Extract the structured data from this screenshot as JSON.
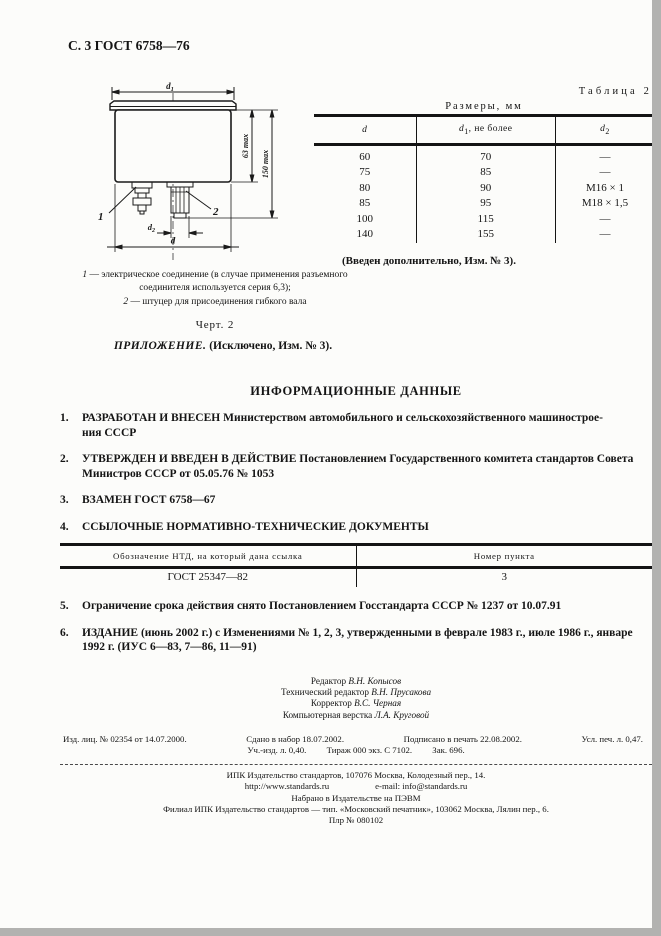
{
  "page_header": "С. 3 ГОСТ 6758—76",
  "figure": {
    "d1_base": "d",
    "d1_sub": "1",
    "max63": "63 max",
    "max150": "150 max",
    "d2_base": "d",
    "d2_sub": "2",
    "d_label": "d",
    "callout1": "1",
    "callout2": "2",
    "note1_num": "1",
    "note1_text": "— электрическое соединение (в случае применения разъемного соединителя используется серия 6,3);",
    "note2_num": "2",
    "note2_text": "— штуцер для присоединения гибкого вала",
    "caption": "Черт. 2"
  },
  "appendix": {
    "italic": "ПРИЛОЖЕНИЕ.",
    "bold": "(Исключено, Изм. № 3)."
  },
  "table2": {
    "label": "Таблица 2",
    "title": "Размеры, мм",
    "h1": "d",
    "h2_base": "d",
    "h2_sub": "1",
    "h2_rest": ", не более",
    "h3_base": "d",
    "h3_sub": "2",
    "rows": [
      [
        "60",
        "70",
        "—"
      ],
      [
        "75",
        "85",
        "—"
      ],
      [
        "80",
        "90",
        "М16 × 1"
      ],
      [
        "85",
        "95",
        "М18 × 1,5"
      ],
      [
        "100",
        "115",
        "—"
      ],
      [
        "140",
        "155",
        "—"
      ]
    ],
    "note": "(Введен дополнительно, Изм. № 3)."
  },
  "info": {
    "title": "ИНФОРМАЦИОННЫЕ ДАННЫЕ",
    "item1_num": "1.",
    "item1_line1": "РАЗРАБОТАН И ВНЕСЕН Министерством автомобильного и сельскохозяйственного машинострое-",
    "item1_line2": "ния СССР",
    "item2_num": "2.",
    "item2_text": "УТВЕРЖДЕН И ВВЕДЕН В ДЕЙСТВИЕ Постановлением Государственного комитета стандартов Совета Министров СССР от 05.05.76 № 1053",
    "item3_num": "3.",
    "item3_text": "ВЗАМЕН ГОСТ 6758—67",
    "item4_num": "4.",
    "item4_text": "ССЫЛОЧНЫЕ НОРМАТИВНО-ТЕХНИЧЕСКИЕ ДОКУМЕНТЫ",
    "item5_num": "5.",
    "item5_text": "Ограничение срока действия снято Постановлением Госстандарта СССР № 1237 от 10.07.91",
    "item6_num": "6.",
    "item6_text": "ИЗДАНИЕ (июнь 2002 г.) с Изменениями №  1, 2, 3, утвержденными в феврале 1983 г., июле 1986 г., январе 1992 г. (ИУС 6—83, 7—86, 11—91)"
  },
  "ref_table": {
    "col1": "Обозначение НТД, на который дана ссылка",
    "col2": "Номер пункта",
    "row": [
      "ГОСТ 25347—82",
      "3"
    ]
  },
  "credits": [
    {
      "role": "Редактор",
      "name": "В.Н. Копысов"
    },
    {
      "role": "Технический редактор",
      "name": "В.Н. Прусакова"
    },
    {
      "role": "Корректор",
      "name": "В.С. Черная"
    },
    {
      "role": "Компьютерная верстка",
      "name": "Л.А. Круговой"
    }
  ],
  "imprint": {
    "line1a": "Изд. лиц. № 02354 от 14.07.2000.",
    "line1b": "Сдано в набор 18.07.2002.",
    "line1c": "Подписано в печать 22.08.2002.",
    "line1d": "Усл. печ. л. 0,47.",
    "line2a": "Уч.-изд. л. 0,40.",
    "line2b": "Тираж 000 экз. С 7102.",
    "line2c": "Зак. 696.",
    "pub1": "ИПК Издательство стандартов, 107076 Москва, Колодезный пер., 14.",
    "pub2a": "http://www.standards.ru",
    "pub2b": "e-mail: info@standards.ru",
    "pub3": "Набрано в Издательстве на ПЭВМ",
    "pub4": "Филиал ИПК Издательство стандартов — тип. «Московский печатник», 103062 Москва, Лялин пер., 6.",
    "pub5": "Плр № 080102"
  }
}
